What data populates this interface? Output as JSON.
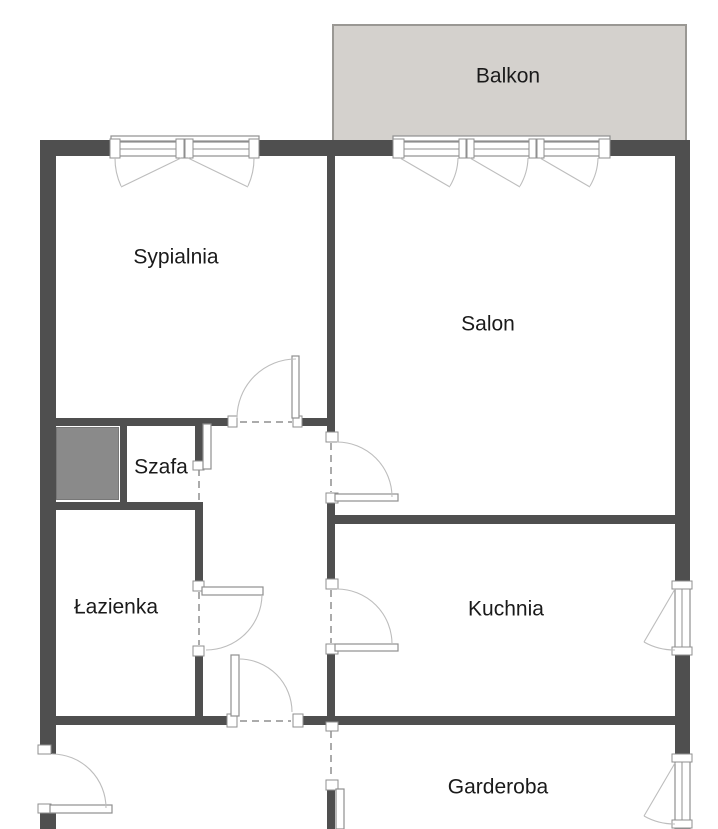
{
  "floorplan": {
    "rooms": {
      "balkon": {
        "label": "Balkon"
      },
      "sypialnia": {
        "label": "Sypialnia"
      },
      "salon": {
        "label": "Salon"
      },
      "szafa": {
        "label": "Szafa"
      },
      "lazienka": {
        "label": "Łazienka"
      },
      "kuchnia": {
        "label": "Kuchnia"
      },
      "garderoba": {
        "label": "Garderoba"
      }
    },
    "colors": {
      "wall": "#4f4f4f",
      "balcony_fill": "#d4d1cd",
      "balcony_border": "#9a9894",
      "shaft_fill": "#8a8a8a",
      "door_line": "#8f8f8f",
      "arc_line": "#bdbdbd",
      "text": "#1a1a1a",
      "background": "#ffffff"
    }
  }
}
